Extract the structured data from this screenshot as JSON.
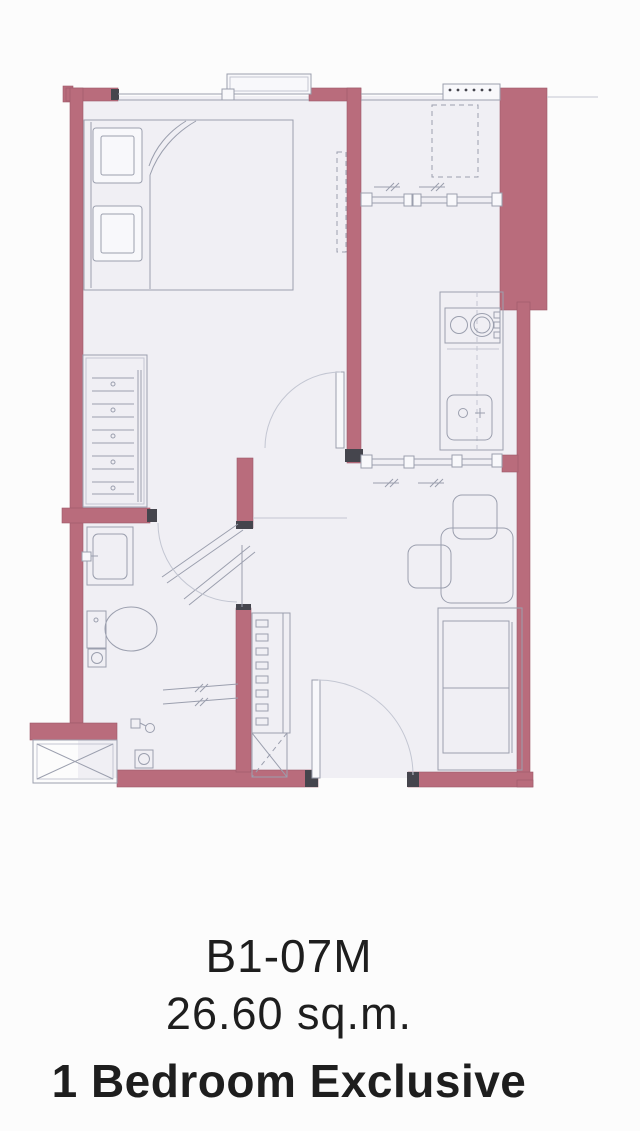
{
  "unit": {
    "code": "B1-07M",
    "area": "26.60 sq.m.",
    "type": "1 Bedroom Exclusive"
  },
  "plan": {
    "colors": {
      "wall": "#b96c7c",
      "wall_edge": "#9d5a6b",
      "floor": "#f0eff4",
      "fixture_fill": "#f8f8fb",
      "shaft_fill": "#fafafc",
      "line": "#9b9fae",
      "faint_line": "#c3c6d2",
      "cap": "#45454d",
      "background": "#fcfcfc",
      "text": "#1e1e1e"
    },
    "symbols": [
      "double-bed",
      "pillows",
      "wardrobe-with-hangers",
      "wall-ac-unit",
      "window-with-sill",
      "balcony-louver-vent",
      "ac-condenser-dashed",
      "sliding-window",
      "sliding-partition",
      "kitchen-counter",
      "cooktop-two-burners",
      "kitchen-sink",
      "bathroom-vanity",
      "toilet",
      "floor-drain",
      "shower-set",
      "folding-shower-door",
      "door-swing-arc",
      "entry-door",
      "shoe-shelf",
      "x-braced-cabinet",
      "service-shaft",
      "dining-table",
      "chairs",
      "sofa"
    ]
  }
}
